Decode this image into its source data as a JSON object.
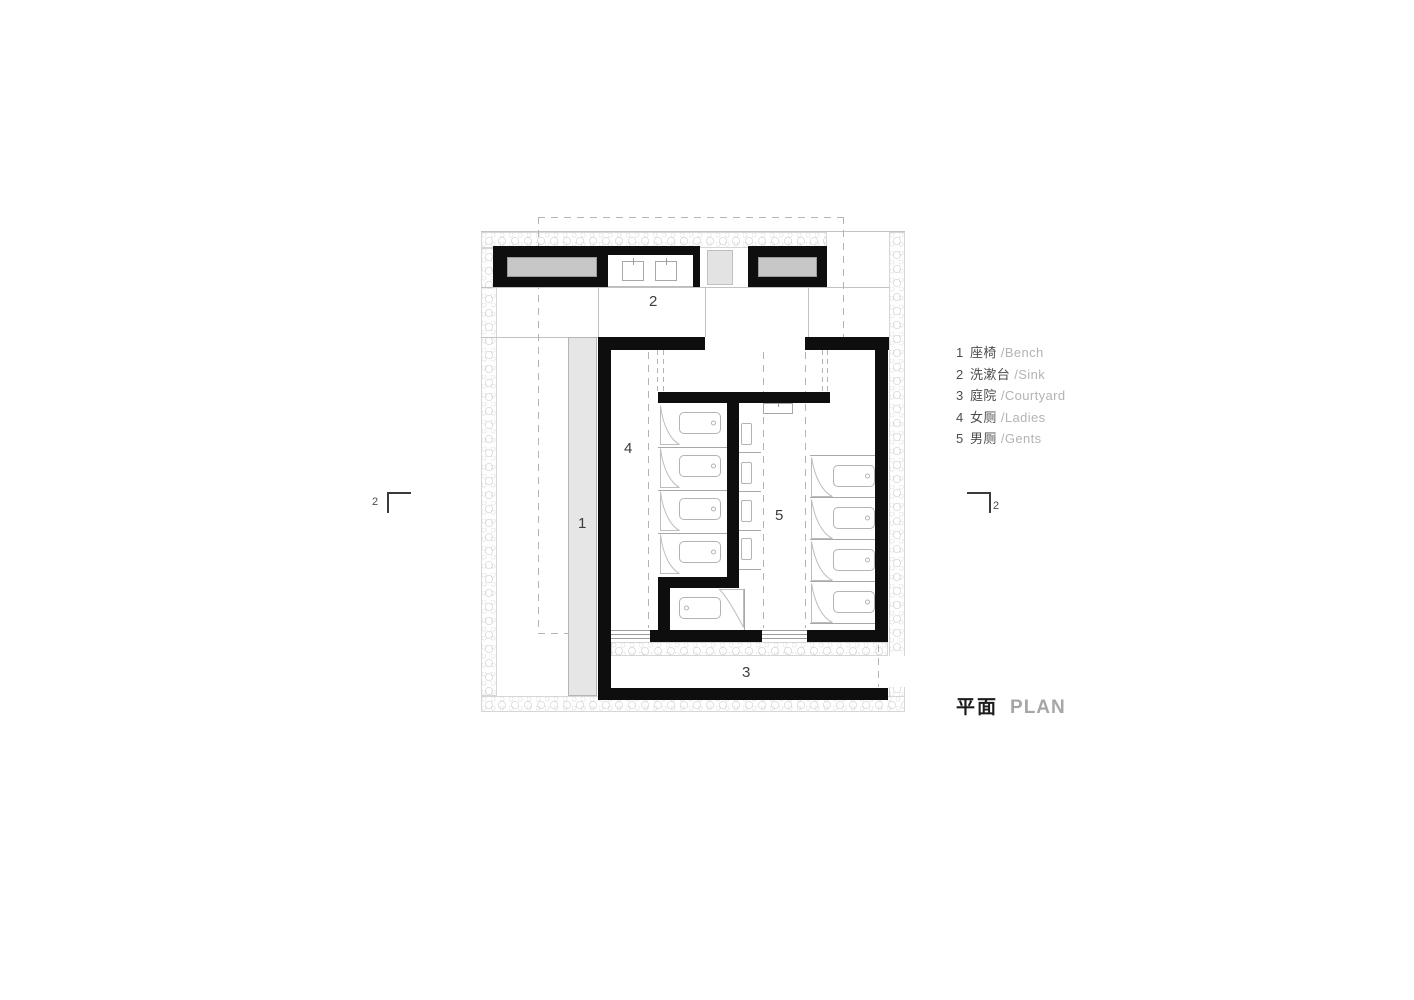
{
  "title": {
    "cn": "平面",
    "en": "PLAN"
  },
  "legend": {
    "items": [
      {
        "num": "1",
        "cn": "座椅",
        "en": "/Bench"
      },
      {
        "num": "2",
        "cn": "洗漱台",
        "en": "/Sink"
      },
      {
        "num": "3",
        "cn": "庭院",
        "en": "/Courtyard"
      },
      {
        "num": "4",
        "cn": "女厕",
        "en": "/Ladies"
      },
      {
        "num": "5",
        "cn": "男厕",
        "en": "/Gents"
      }
    ]
  },
  "plan_labels": {
    "bench": "1",
    "sink": "2",
    "courtyard": "3",
    "ladies": "4",
    "gents": "5"
  },
  "section_markers": {
    "left": "2",
    "right": "2"
  },
  "colors": {
    "wall": "#0e0e0e",
    "bench_fill": "#c7c7c7",
    "walkway_fill": "#e3e3e3",
    "bench_strip_fill": "#e6e6e6",
    "hatch_line": "#c9c9c9",
    "dash_line": "#b3b3b3",
    "text_dark": "#4d4d4d",
    "text_light": "#b3b3b3"
  }
}
